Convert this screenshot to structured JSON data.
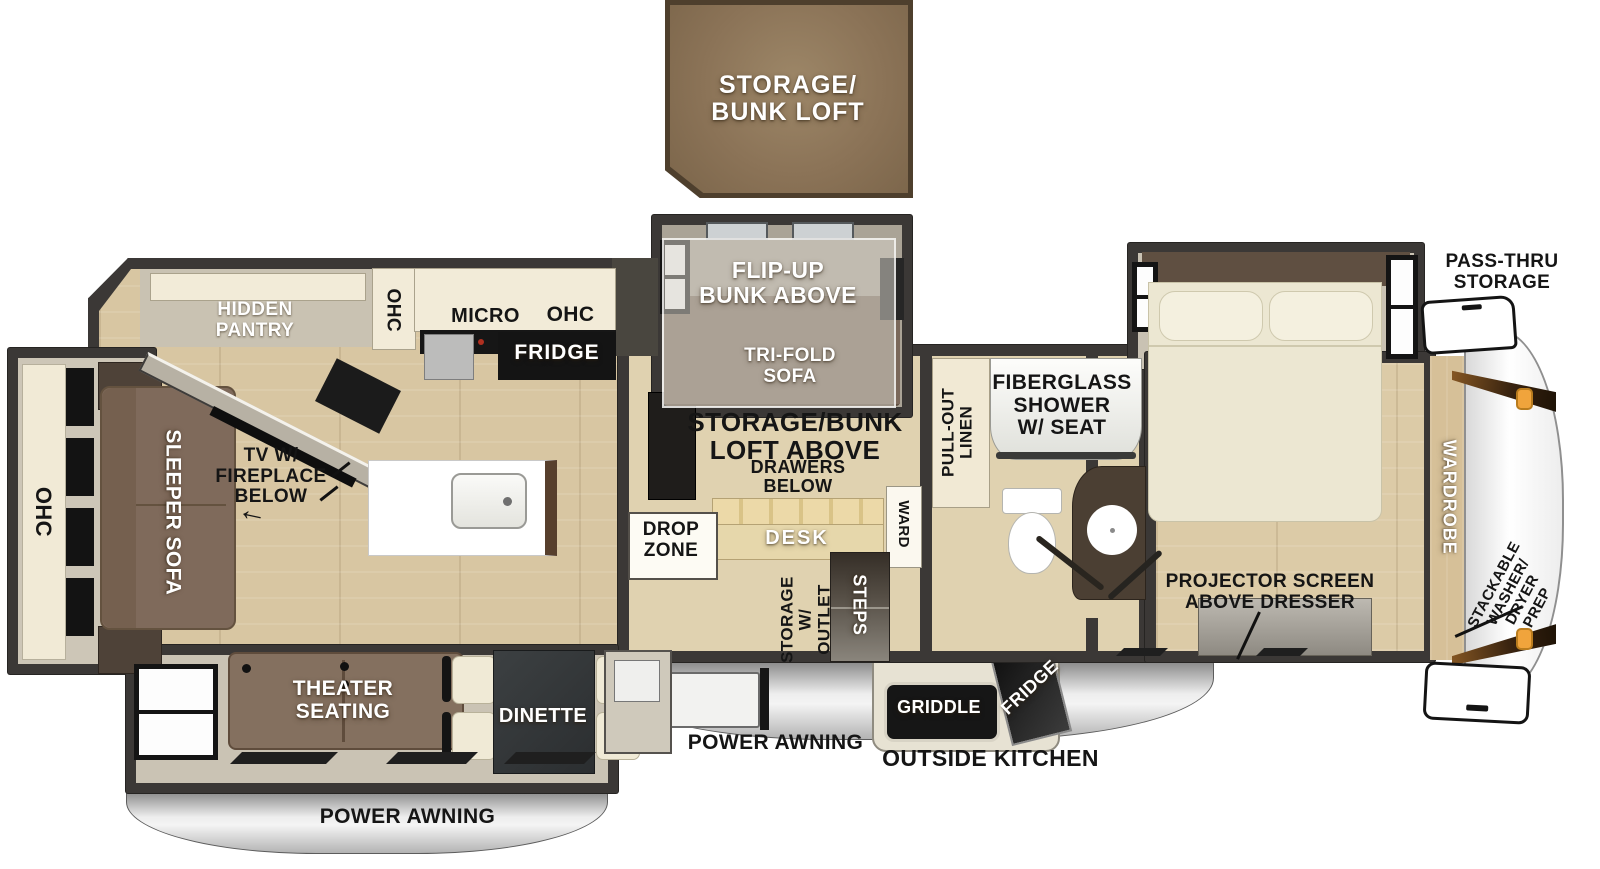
{
  "title": "Fifth wheel RV floor plan",
  "colors": {
    "wall": "#3b3836",
    "floor_wood": "#d8c6a2",
    "slide_floor": "#ccc5b6",
    "callout_brown": "#8b7357",
    "sofa_brown": "#7f6a5b",
    "cabinet_cream": "#f2ebd7",
    "furniture_black": "#1c1c1c",
    "awning_silver": "#d9d9d9",
    "marker_orange": "#f0a43c"
  },
  "labels": {
    "loft_callout": "STORAGE/\nBUNK LOFT",
    "flip_up_bunk": "FLIP-UP\nBUNK ABOVE",
    "tri_fold_sofa": "TRI-FOLD\nSOFA",
    "pass_thru_storage": "PASS-THRU\nSTORAGE",
    "hidden_pantry": "HIDDEN\nPANTRY",
    "ohc_kitchen": "OHC",
    "micro": "MICRO",
    "ohc_top": "OHC",
    "fridge": "FRIDGE",
    "tv_fireplace": "TV W/\nFIREPLACE\nBELOW",
    "tv_arrow": "←",
    "sleeper_sofa": "SLEEPER SOFA",
    "ohc_rear": "OHC",
    "storage_bunk_loft_above": "STORAGE/BUNK\nLOFT ABOVE",
    "drawers_below": "DRAWERS\nBELOW",
    "desk": "DESK",
    "drop_zone": "DROP\nZONE",
    "ward": "WARD",
    "pull_out_linen": "PULL-OUT\nLINEN",
    "fiberglass_shower": "FIBERGLASS\nSHOWER\nW/ SEAT",
    "storage_w_outlet": "STORAGE\nW/ OUTLET",
    "steps": "STEPS",
    "projector_screen": "PROJECTOR SCREEN\nABOVE DRESSER",
    "wardrobe": "WARDROBE",
    "stackable": "STACKABLE\nWASHER/\nDRYER\nPREP",
    "theater_seating": "THEATER\nSEATING",
    "dinette": "DINETTE",
    "power_awning_rear": "POWER AWNING",
    "power_awning_main": "POWER AWNING",
    "outside_kitchen": "OUTSIDE KITCHEN",
    "griddle": "GRIDDLE",
    "outside_fridge": "FRIDGE"
  }
}
